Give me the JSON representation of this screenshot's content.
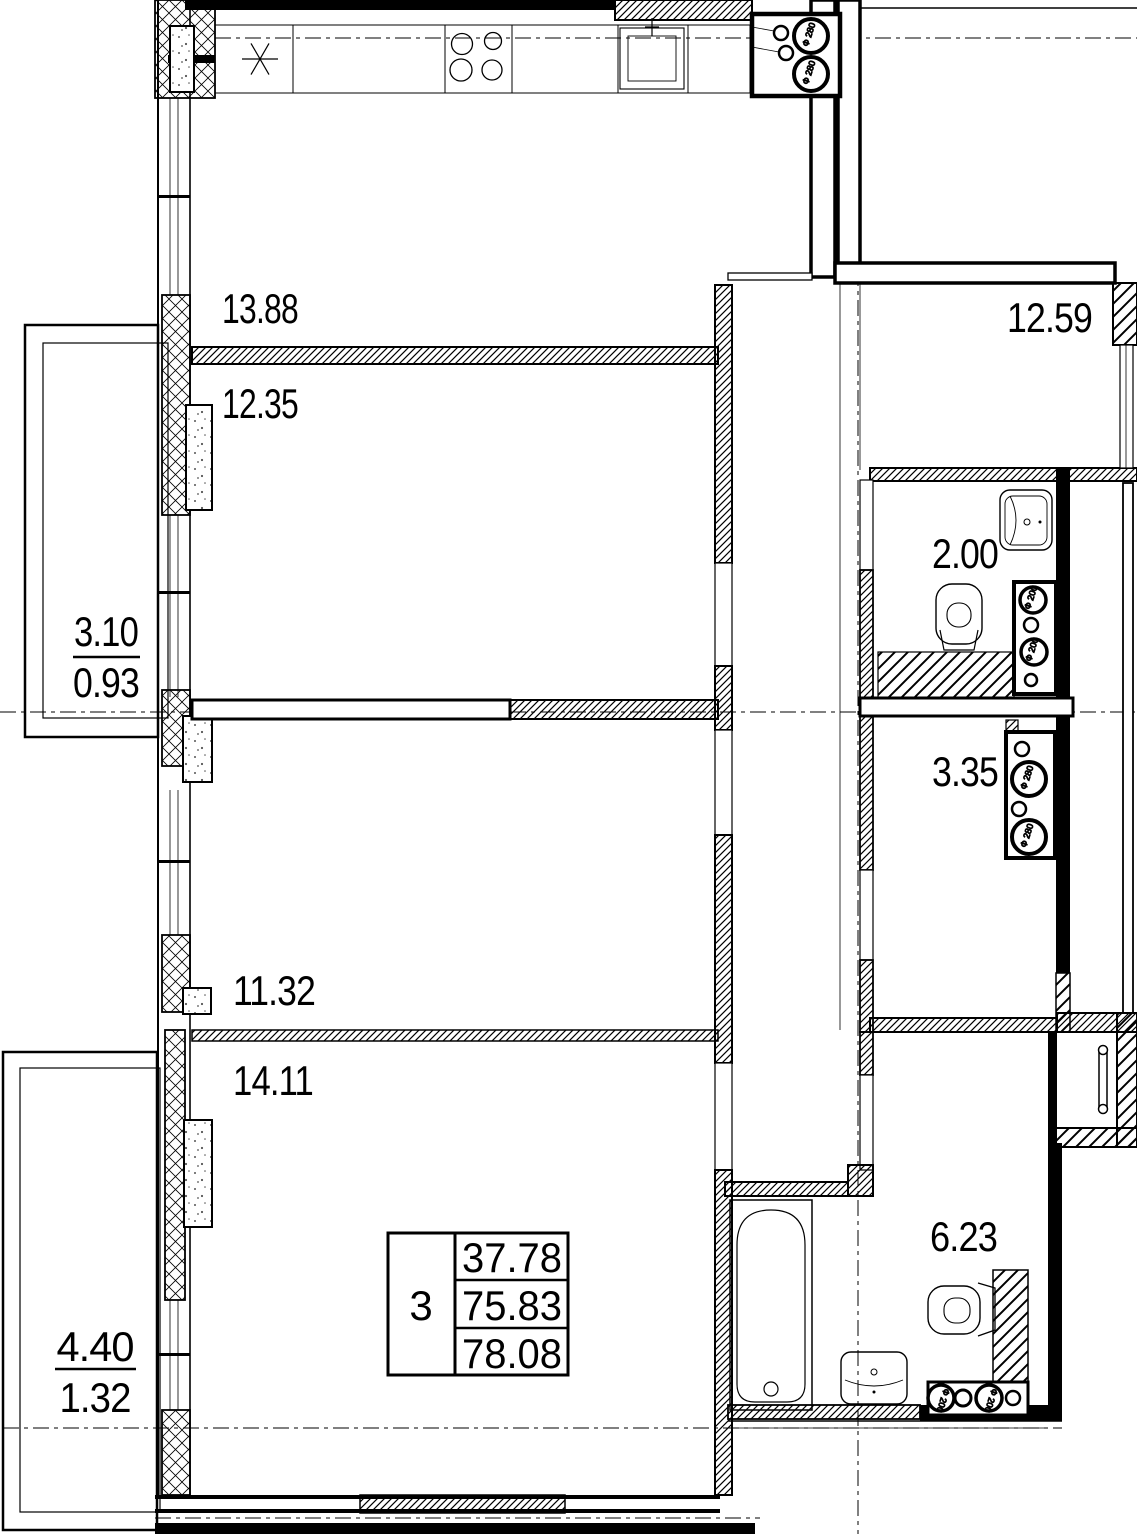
{
  "plan": {
    "rooms": [
      {
        "id": "kitchen",
        "area": "13.88"
      },
      {
        "id": "room-1",
        "area": "12.35"
      },
      {
        "id": "hallway",
        "area": "12.59"
      },
      {
        "id": "wc",
        "area": "2.00"
      },
      {
        "id": "storage",
        "area": "3.35"
      },
      {
        "id": "room-2",
        "area": "11.32"
      },
      {
        "id": "room-3",
        "area": "14.11"
      },
      {
        "id": "bathroom",
        "area": "6.23"
      }
    ],
    "balconies": [
      {
        "id": "balcony-top",
        "full_area": "3.10",
        "reduced_area": "0.93"
      },
      {
        "id": "balcony-bottom",
        "full_area": "4.40",
        "reduced_area": "1.32"
      }
    ],
    "summary_table": {
      "rooms_count": "3",
      "living_area": "37.78",
      "floor_area": "75.83",
      "total_area": "78.08"
    },
    "vent_labels": {
      "d280": "Ф 280",
      "d200": "Ф 200"
    },
    "colors": {
      "line": "#000000",
      "background": "#ffffff"
    }
  }
}
